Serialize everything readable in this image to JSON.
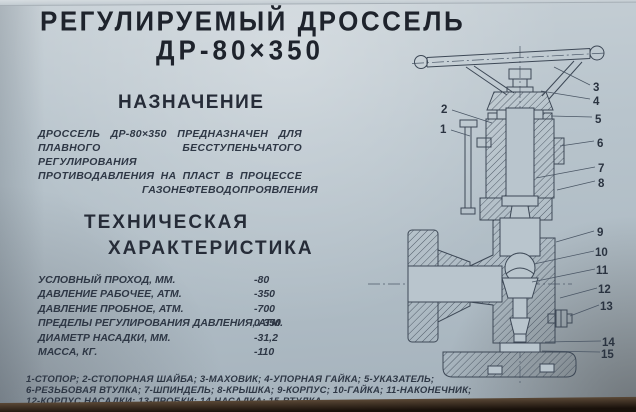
{
  "title": {
    "line1": "РЕГУЛИРУЕМЫЙ ДРОССЕЛЬ",
    "line2": "ДР-80×350"
  },
  "purpose": {
    "heading": "НАЗНАЧЕНИЕ",
    "lines": [
      "ДРОССЕЛЬ ДР-80×350 ПРЕДНАЗНАЧЕН ДЛЯ",
      "ПЛАВНОГО БЕССТУПЕНЬЧАТОГО РЕГУЛИРОВАНИЯ",
      "ПРОТИВОДАВЛЕНИЯ НА ПЛАСТ В ПРОЦЕССЕ",
      "ГАЗОНЕФТЕВОДОПРОЯВЛЕНИЯ"
    ]
  },
  "specs": {
    "heading_line1": "ТЕХНИЧЕСКАЯ",
    "heading_line2": "ХАРАКТЕРИСТИКА",
    "rows": [
      {
        "label": "УСЛОВНЫЙ ПРОХОД,  ММ.",
        "value": "-80"
      },
      {
        "label": "ДАВЛЕНИЕ РАБОЧЕЕ,  АТМ.",
        "value": "-350"
      },
      {
        "label": "ДАВЛЕНИЕ ПРОБНОЕ,  АТМ.",
        "value": "-700"
      },
      {
        "label": "ПРЕДЕЛЫ РЕГУЛИРОВАНИЯ ДАВЛЕНИЯ, АТМ.",
        "value": "0-350"
      },
      {
        "label": "ДИАМЕТР НАСАДКИ,  ММ.",
        "value": "-31,2"
      },
      {
        "label": "МАССА,  КГ.",
        "value": "-110"
      }
    ]
  },
  "legend": {
    "lines": [
      "1-СТОПОР; 2-СТОПОРНАЯ ШАЙБА; 3-МАХОВИК; 4-УПОРНАЯ ГАЙКА; 5-УКАЗАТЕЛЬ;",
      "6-РЕЗЬБОВАЯ ВТУЛКА; 7-ШПИНДЕЛЬ; 8-КРЫШКА; 9-КОРПУС; 10-ГАЙКА; 11-НАКОНЕЧНИК;",
      "12-КОРПУС НАСАДКИ; 13-ПРОБКИ; 14-НАСАДКА; 15-ВТУЛКА."
    ]
  },
  "drawing": {
    "callouts": [
      "1",
      "2",
      "3",
      "4",
      "5",
      "6",
      "7",
      "8",
      "9",
      "10",
      "11",
      "12",
      "13",
      "14",
      "15"
    ]
  },
  "colors": {
    "poster_background": "#b8c4cc",
    "title_ink": "#1e232c",
    "handwriting_ink": "#2e3745",
    "drawing_line": "#3d4856"
  }
}
